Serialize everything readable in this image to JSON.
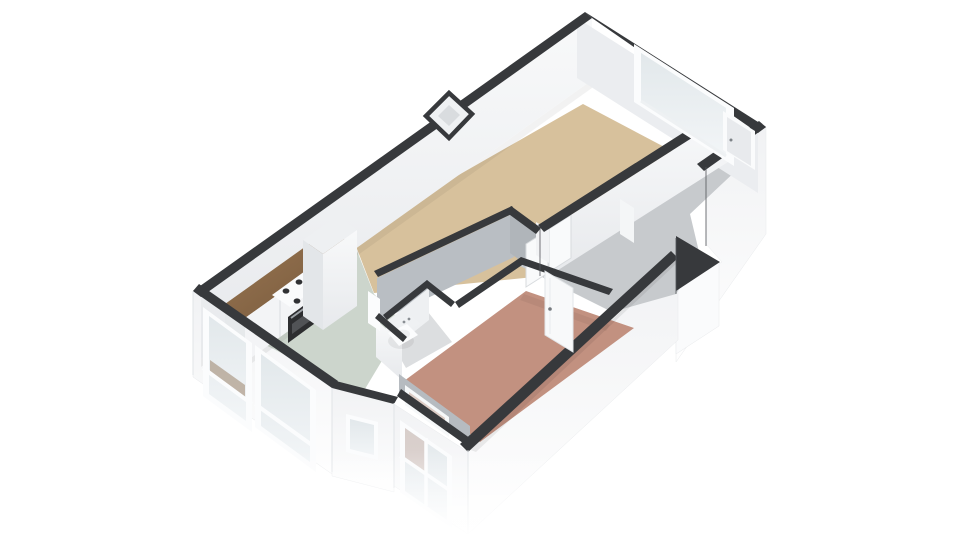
{
  "scene": {
    "type": "3d-floorplan-render",
    "view": "isometric-top-down",
    "background": "#ffffff",
    "description": "3D cutaway floor plan of a one-bedroom apartment viewed from above at an angle"
  },
  "palette": {
    "wall_top": "#37393c",
    "wall_face_lit": "#f6f7f9",
    "wall_face_shadow": "#b7bcc1",
    "exterior_face": "#f4f5f7",
    "glass": "#e7ecef",
    "wood": "#8a6a4c",
    "appliance_dark": "#2d2e30"
  },
  "rooms": [
    {
      "id": "living-room",
      "label": "Living room / dining strip",
      "floor_color": "#d7c19c"
    },
    {
      "id": "kitchen",
      "label": "Kitchen",
      "floor_color": "#ccd5cc"
    },
    {
      "id": "bedroom",
      "label": "Bedroom",
      "floor_color": "#c29180"
    },
    {
      "id": "hallway",
      "label": "Hallway / entry corridor",
      "floor_color": "#c7cacd"
    },
    {
      "id": "toilet",
      "label": "Toilet",
      "floor_color": "#dcdee0"
    },
    {
      "id": "vestibule",
      "label": "Entry nook",
      "floor_color": "#c9ccd0"
    }
  ],
  "fixtures": [
    {
      "id": "kitchen-counter",
      "label": "Kitchen counter with wood worktop"
    },
    {
      "id": "cooktop",
      "label": "4-burner cooktop"
    },
    {
      "id": "oven",
      "label": "Built-in oven"
    },
    {
      "id": "tall-cabinet",
      "label": "Tall cabinet / fridge"
    },
    {
      "id": "toilet-fixture",
      "label": "Toilet"
    }
  ],
  "openings": {
    "windows": [
      "living-room-window",
      "kitchen-window-1",
      "kitchen-window-2",
      "utility-window",
      "bedroom-window"
    ],
    "doors": [
      "front-door",
      "hall-double-door",
      "bedroom-door",
      "toilet-door"
    ]
  }
}
